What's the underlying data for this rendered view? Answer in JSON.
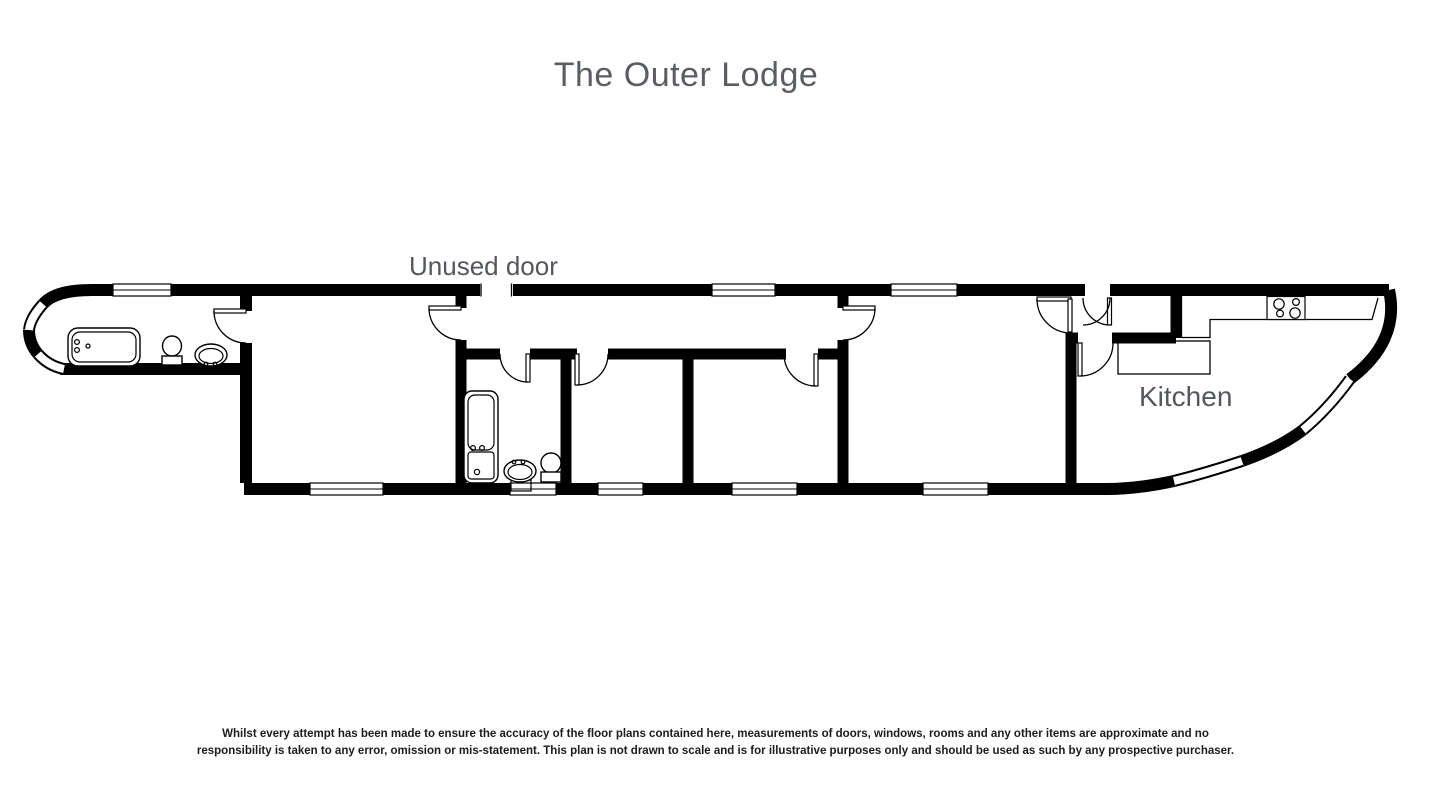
{
  "header": {
    "title": "The Outer Lodge"
  },
  "plan": {
    "type": "floorplan",
    "labels": {
      "unused_door": "Unused door",
      "kitchen": "Kitchen"
    },
    "colors": {
      "background": "#ffffff",
      "walls": "#000000",
      "room_label_text": "#54575b",
      "title_text": "#5a5d61",
      "disclaimer_text": "#1c1c1c"
    },
    "fixtures": {
      "bathroom_left": [
        "bathtub",
        "toilet",
        "sink"
      ],
      "bathroom_middle": [
        "bathtub",
        "sink",
        "toilet"
      ],
      "kitchen": [
        "hob",
        "counter"
      ]
    },
    "window_count": 12,
    "door_count": 9
  },
  "footer": {
    "disclaimer_line1": "Whilst every attempt has been made to ensure the accuracy of the floor plans contained here, measurements of doors, windows, rooms and any other items are approximate and no",
    "disclaimer_line2": "responsibility is taken to any error, omission or mis-statement. This plan is not drawn to scale and is for illustrative purposes only and should be used as such by any prospective purchaser."
  }
}
